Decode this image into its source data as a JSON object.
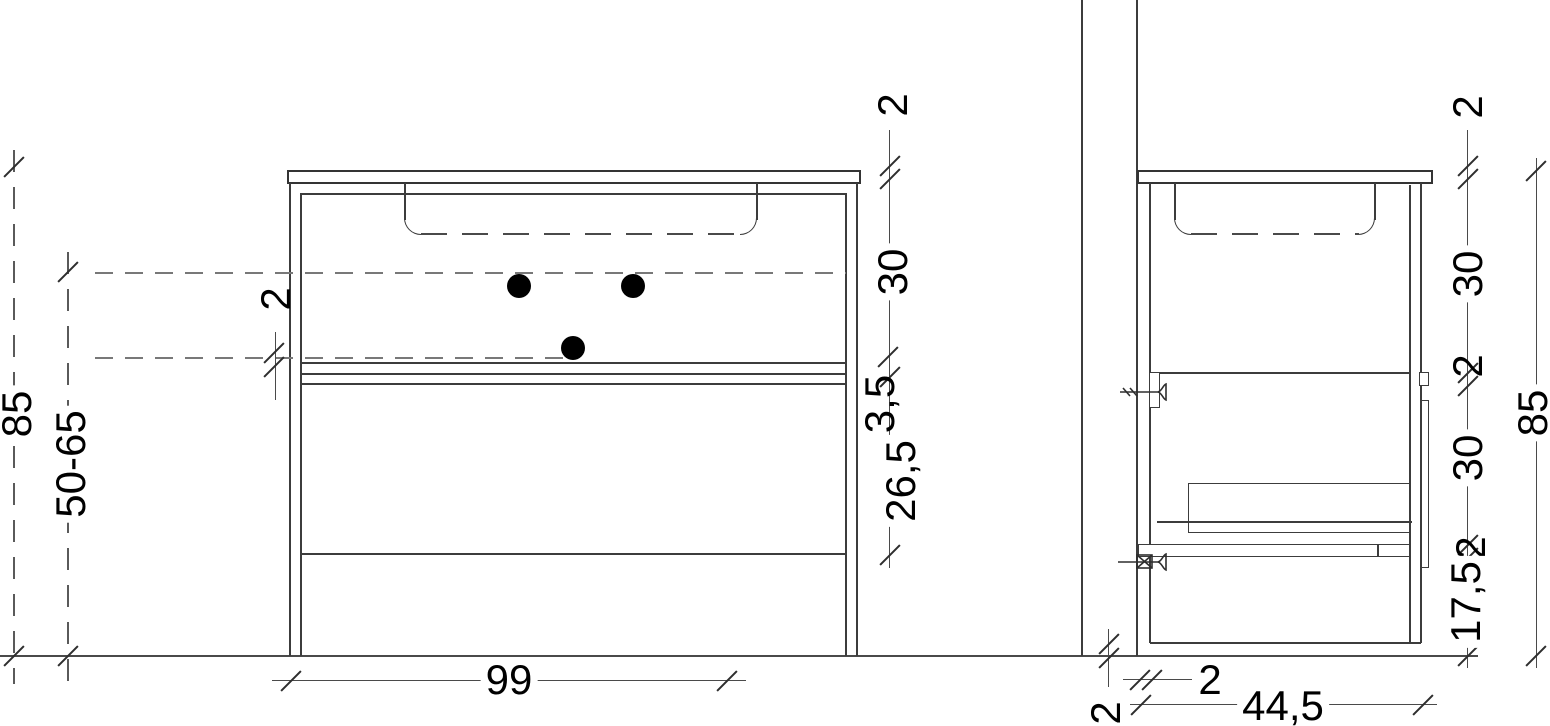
{
  "front_view": {
    "total_height": "85",
    "mount_height_range": "50-65",
    "basin_bottom_thickness": "2",
    "top_thickness": "2",
    "upper_section_height": "30",
    "divider_gap": "3,5",
    "lower_section_height": "26,5",
    "width": "99"
  },
  "side_view": {
    "top_thickness": "2",
    "upper_section_height": "30",
    "divider_thickness": "2",
    "lower_section_height": "30",
    "bottom_thickness": "2",
    "leg_zone_height": "17,5",
    "total_height": "85",
    "floor_clearance": "2",
    "back_panel_thickness": "2",
    "depth": "44,5"
  }
}
